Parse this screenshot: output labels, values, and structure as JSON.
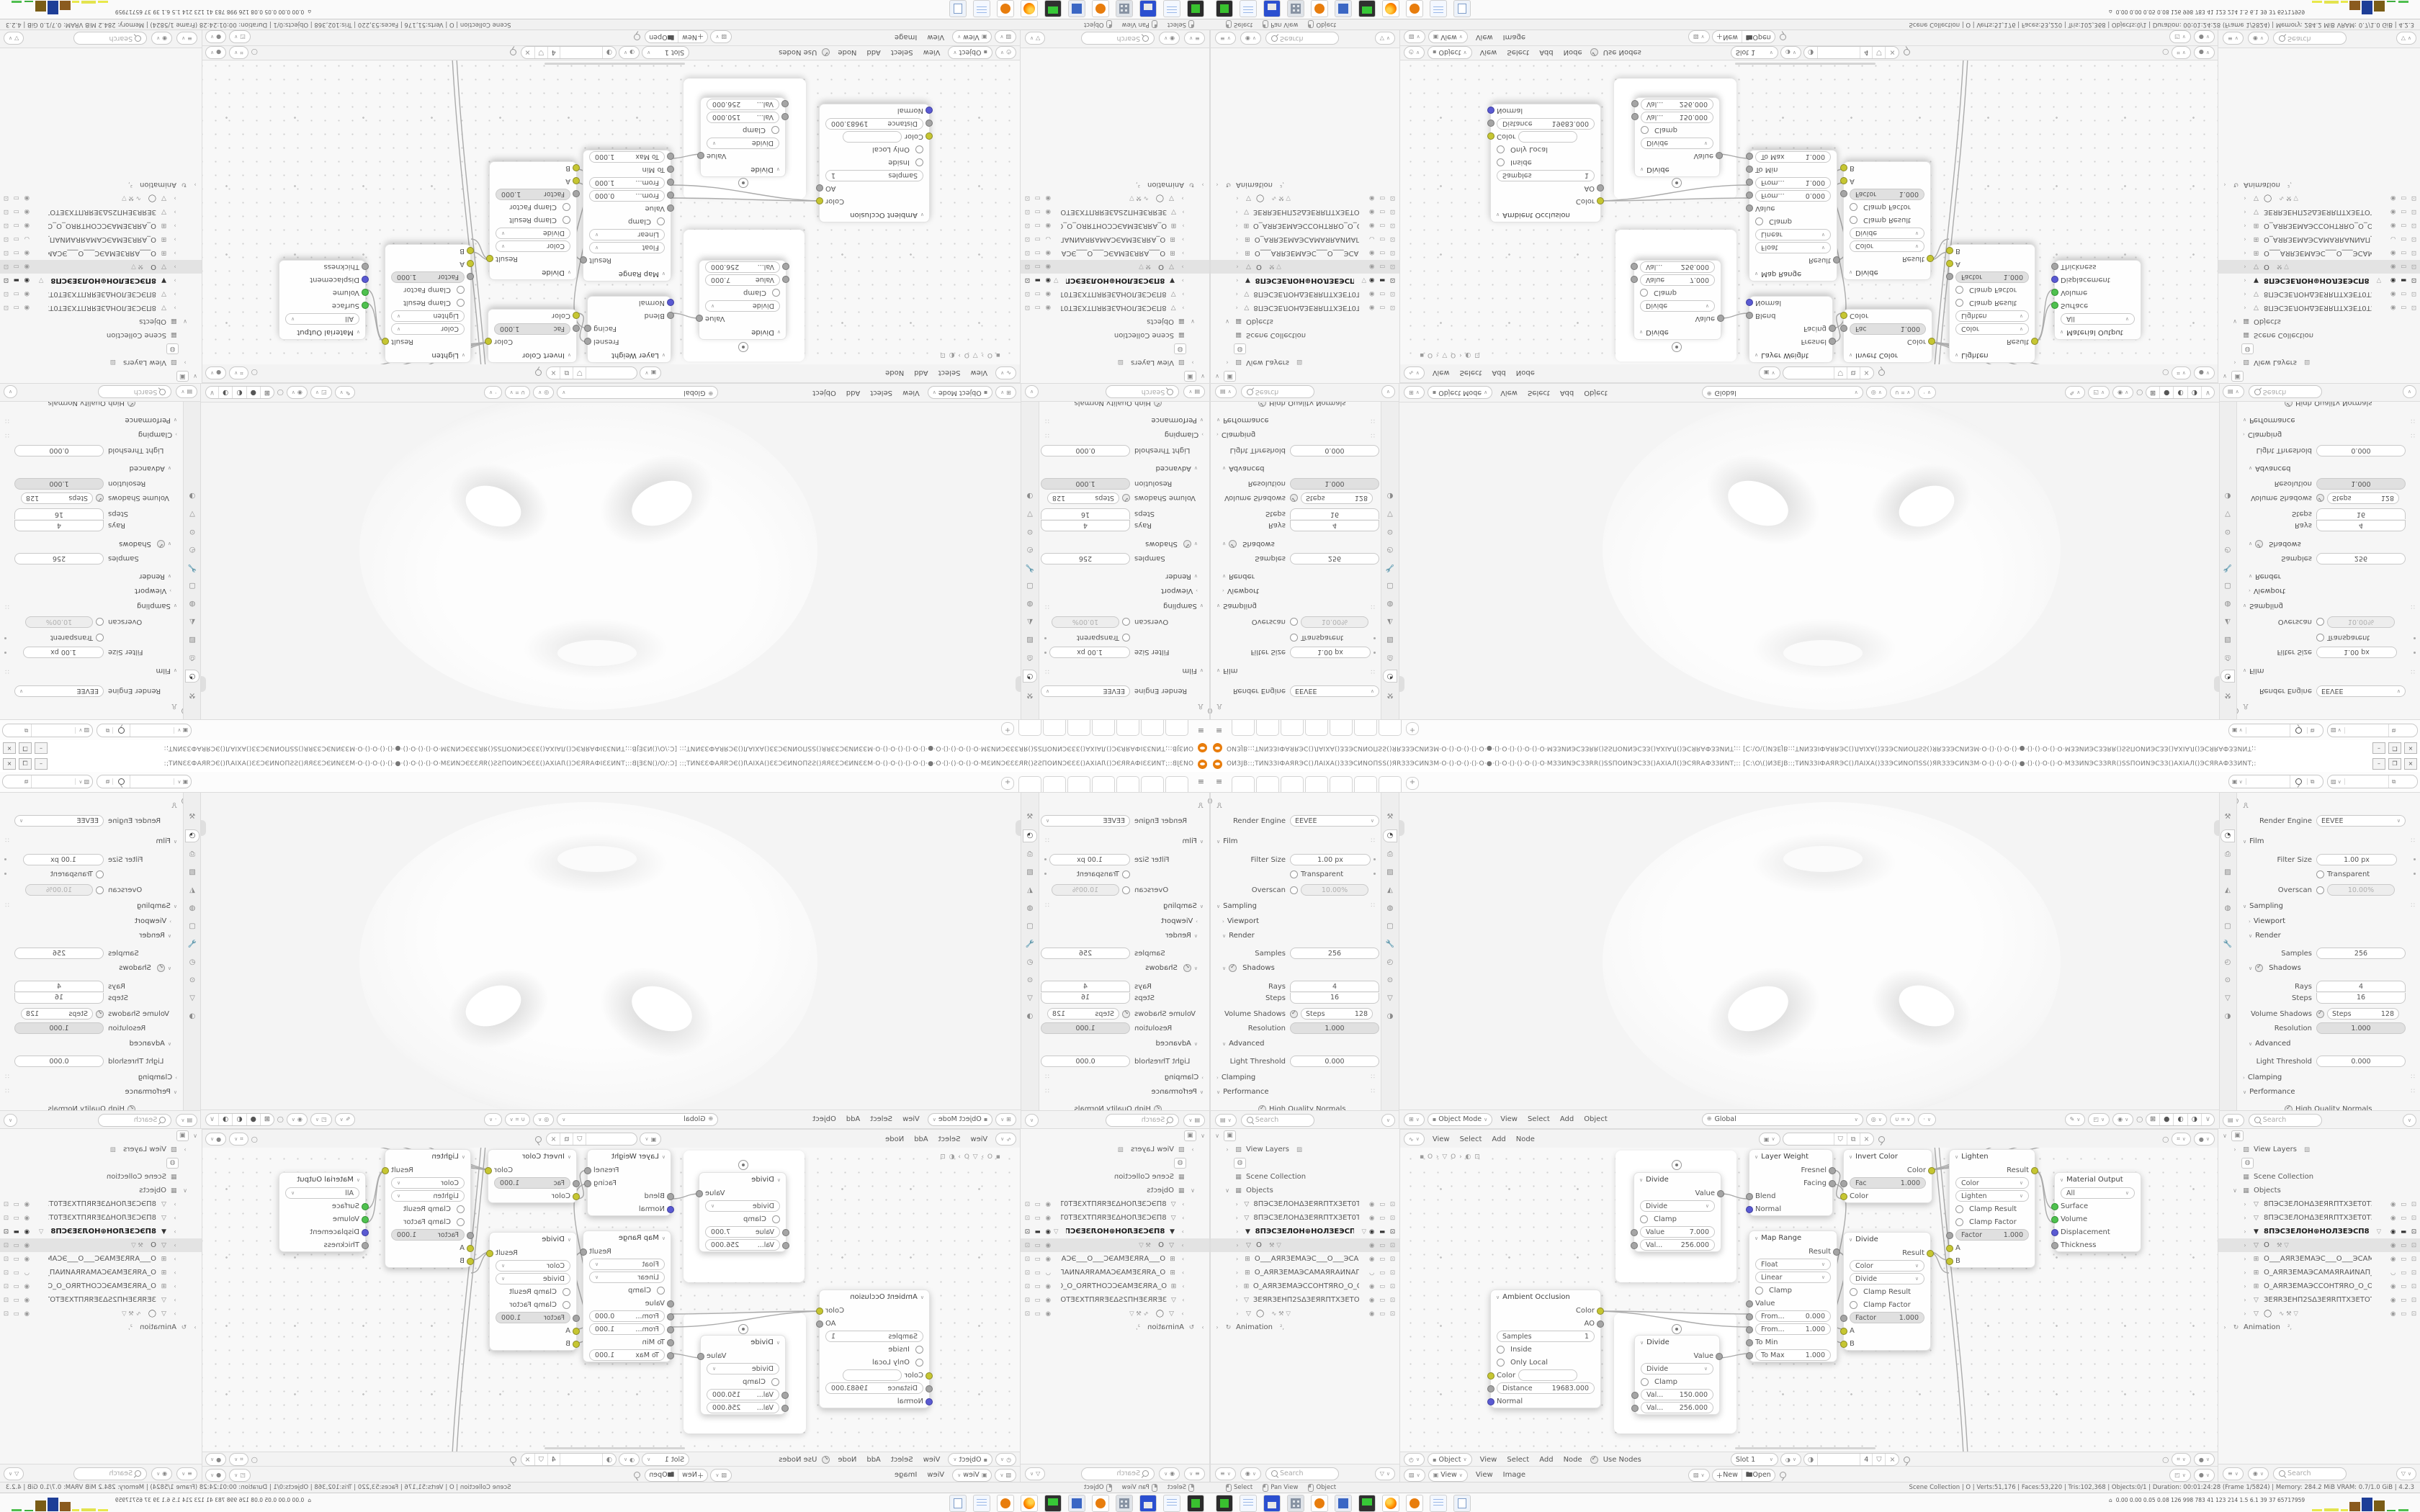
{
  "ui": {
    "single": [
      0
    ]
  },
  "window": {
    "title": "ОИЗЈВ::;ТИNЗЗІФАЯRЭС()ЛАІХА()ЗЗЭСИNОПSS()ЯRЗЗЭСИNЗМ·О·()·О·()·()·О·●·()·О·()·()·О·()·О·МЗЗИNЭСЗЗRR()SSПОИNЭСЗЗ()АХІАЛ()ЭСЯRАФЗЗИNТ;:: [С:\\О\\()ИЗЕЈВ::;ТИNЗЗІФАЯRЭС()ЛАІХА()ЗЗЭСИNОПSS()ЯRЗЗЭСИNЗМ·О·()·()·О·()·●·()·()·О·()·О·МЗЗИNЭСЗЗRR()SSПОИNЭСЗЗ()АХІАЛ()ЭСЯRАФЗЗИNТ;:",
    "btn_min": "–",
    "btn_max": "❒",
    "btn_close": "×"
  },
  "topbar": {
    "menu_icon": "≡",
    "add_tab": "+",
    "tabs": [
      "",
      "",
      "",
      "",
      "",
      "",
      ""
    ]
  },
  "props": {
    "engine_label": "Render Engine",
    "engine": "EEVEE",
    "film": "Film",
    "filter_size": "Filter Size",
    "filter_size_val": "1.00 px",
    "transparent": "Transparent",
    "overscan": "Overscan",
    "overscan_val": "10.00%",
    "sampling": "Sampling",
    "viewport": "Viewport",
    "render": "Render",
    "samples": "Samples",
    "samples_val": "256",
    "shadows": "Shadows",
    "rays": "Rays",
    "rays_val": "4",
    "steps": "Steps",
    "steps_val": "16",
    "volume_shadows": "Volume Shadows",
    "vs_steps_label": "Steps",
    "vs_steps_val": "128",
    "resolution": "Resolution",
    "resolution_val": "1.000",
    "advanced": "Advanced",
    "light_threshold": "Light Threshold",
    "light_threshold_val": "0.000",
    "clamping": "Clamping",
    "performance": "Performance",
    "hq_normals": "High Quality Normals",
    "search_placeholder": "Search"
  },
  "viewport_header": {
    "mode": "Object Mode",
    "menus": [
      "View",
      "Select",
      "Add",
      "Object"
    ],
    "orientation": "Global"
  },
  "node_editor": {
    "menus": [
      "View",
      "Select",
      "Add",
      "Node"
    ],
    "breadcrumb": "▪ O  ›  ▽ O  ›  ◐ ⊡",
    "nodes": {
      "d1": {
        "t": "Divide",
        "o": "Value",
        "op": "Divide",
        "c": "Clamp",
        "al": "Value",
        "av": "7.000",
        "bl": "Val...",
        "bv": "256.000"
      },
      "d2": {
        "t": "Divide",
        "o": "Value",
        "op": "Divide",
        "c": "Clamp",
        "al": "Val...",
        "av": "150.000",
        "bl": "Val...",
        "bv": "256.000"
      },
      "ao": {
        "t": "Ambient Occlusion",
        "o1": "Color",
        "o2": "AO",
        "s": "Samples",
        "sv": "1",
        "ins": "Inside",
        "ol": "Only Local",
        "ci": "Color",
        "di": "Distance",
        "dv": "19683.000",
        "ni": "Normal"
      },
      "lw": {
        "t": "Layer Weight",
        "o1": "Fresnel",
        "o2": "Facing",
        "i1": "Blend",
        "i2": "Normal"
      },
      "mr": {
        "t": "Map Range",
        "o": "Result",
        "t1": "Float",
        "t2": "Linear",
        "c": "Clamp",
        "v": "Value",
        "f1": "From...",
        "f1v": "0.000",
        "f2": "From...",
        "f2v": "1.000",
        "tm": "To Min",
        "tx": "To Max",
        "txv": "1.000"
      },
      "ic": {
        "t": "Invert Color",
        "o": "Color",
        "f": "Fac",
        "fv": "1.000",
        "i": "Color"
      },
      "d3": {
        "t": "Divide",
        "o": "Result",
        "m1": "Color",
        "m2": "Divide",
        "c1": "Clamp Result",
        "c2": "Clamp Factor",
        "f": "Factor",
        "fv": "1.000",
        "a": "A",
        "b": "B"
      },
      "li": {
        "t": "Lighten",
        "o": "Result",
        "m1": "Color",
        "m2": "Lighten",
        "c1": "Clamp Result",
        "c2": "Clamp Factor",
        "f": "Factor",
        "fv": "1.000",
        "a": "A",
        "b": "B"
      },
      "mo": {
        "t": "Material Output",
        "all": "All",
        "s": "Surface",
        "v": "Volume",
        "d": "Displacement",
        "th": "Thickness"
      }
    }
  },
  "shader_header": {
    "mode": "Object",
    "menus": [
      "View",
      "Select",
      "Add",
      "Node"
    ],
    "use_nodes": "Use Nodes",
    "slot": "Slot 1",
    "users": "4"
  },
  "image_header": {
    "menus": [
      "View",
      "Image"
    ],
    "view": "View",
    "new_btn": "New",
    "open_btn": "Open"
  },
  "outliner": {
    "search_placeholder": "Search",
    "rows": [
      {
        "ind": "0",
        "e": "∨",
        "icon": "▣",
        "label": "",
        "extra": "",
        "right": "",
        "kind": "btn"
      },
      {
        "ind": "1",
        "e": "›",
        "icon": "▨",
        "label": "View Layers",
        "extra": "▨",
        "right": "",
        "kind": ""
      },
      {
        "ind": "1",
        "e": "",
        "icon": "◍",
        "label": "",
        "extra": "",
        "right": "",
        "kind": "btn"
      },
      {
        "ind": "1",
        "e": "",
        "icon": "▦",
        "label": "Scene Collection",
        "extra": "",
        "right": "",
        "kind": ""
      },
      {
        "ind": "1",
        "e": "∨",
        "icon": "▦",
        "label": "Objects",
        "extra": "",
        "right": "",
        "kind": ""
      },
      {
        "ind": "2",
        "e": "›",
        "icon": "▽",
        "label": "8ПЭСЗЕЛОНΔЗЕЯRПТХЗЕТ0ТЗЕХТ",
        "extra": "",
        "right": "◉ ▭ ⊡",
        "kind": ""
      },
      {
        "ind": "2",
        "e": "›",
        "icon": "▽",
        "label": "8ПЭСЗЕЛОНΔЗЕЯRПТХЗЕТ0ТЗЕХТ",
        "extra": "",
        "right": "◉ ▭ ⊡",
        "kind": ""
      },
      {
        "ind": "2",
        "e": "›",
        "icon": "▼",
        "label": "8ПЭСЗЕЛОН⊕НОЛЗЕЭСП8",
        "extra": "▽",
        "right": "◉ ▬ ⊡",
        "kind": "active"
      },
      {
        "ind": "2",
        "e": "›",
        "icon": "▽",
        "label": "O",
        "extra": "⚒ ▽",
        "right": "◉ ▭ ⊡",
        "kind": "selected"
      },
      {
        "ind": "2",
        "e": "›",
        "icon": "⊞",
        "label": "О___АЯRЗЕМАЭС___О___ЭСАМЗ",
        "extra": "",
        "right": "◉ ▭ ⊡",
        "kind": ""
      },
      {
        "ind": "2",
        "e": "›",
        "icon": "⊞",
        "label": "О_АЯRЗЕМАЭСАМАЯRАИNАП_О",
        "extra": "",
        "right": "◡ ▭ ⊡",
        "kind": ""
      },
      {
        "ind": "2",
        "e": "›",
        "icon": "⊞",
        "label": "О_АЯRЗЕМАЭССОНТЯRО_О_ОЯRТН",
        "extra": "",
        "right": "◉ ▭ ⊡",
        "kind": ""
      },
      {
        "ind": "2",
        "e": "›",
        "icon": "▽",
        "label": "ЗЕЯRЗЕНП2SΔЗЕЯRПТХЗЕТОТЗЕХТ",
        "extra": "",
        "right": "◉ ▭ ⊡",
        "kind": ""
      },
      {
        "ind": "2",
        "e": "›",
        "icon": "▽",
        "label": "◯",
        "extra": "∿ ⚒ ▽",
        "right": "◉ ▭ ⊡",
        "kind": ""
      },
      {
        "ind": "0",
        "e": "›",
        "icon": "↻",
        "label": "Animation",
        "extra": "²,",
        "right": "",
        "kind": ""
      }
    ]
  },
  "statusbar": {
    "hints": [
      "Select",
      "Pan View",
      "Object"
    ],
    "stats": "Scene Collection | O | Verts:51,176 | Faces:53,220 | Tris:102,368 | Objects:0/1 | Duration: 00:01:24:28 (Frame 1/5824) | Memory: 284.2 MiB   VRAM: 0.7/1.0 GiB | 4.2.3"
  },
  "taskbar": {
    "monitor_glyph": "⌂",
    "monitor_values": "0.00 0.00 0.05 0.08  126  998  783   41   123  214  1.5   6.1   39    37  65717959",
    "icons": [
      {
        "k": "term"
      },
      {
        "k": "pad"
      },
      {
        "k": "save"
      },
      {
        "k": "calc"
      },
      {
        "k": "blender"
      },
      {
        "k": "calc2"
      },
      {
        "k": "mon"
      },
      {
        "k": "ff"
      },
      {
        "k": "blender"
      },
      {
        "k": "pad"
      },
      {
        "k": "scroll"
      }
    ],
    "bars": [
      {
        "style": "left:0px;width:14px;height:3px;background:#e8e84a"
      },
      {
        "style": "left:17px;width:20px;height:4px;background:#e3e34d"
      },
      {
        "style": "left:40px;width:10px;height:3px;background:#e8e84a"
      },
      {
        "style": "left:52px;width:15px;height:13px;background:#8a5a1f"
      },
      {
        "style": "left:69px;width:15px;height:19px;background:#1e3e97"
      },
      {
        "style": "left:86px;width:15px;height:15px;background:#7a5c16"
      },
      {
        "style": "left:104px;width:12px;height:2px;background:#3fae3f"
      },
      {
        "style": "left:120px;width:14px;height:3px;background:#4fbf4f"
      }
    ]
  }
}
